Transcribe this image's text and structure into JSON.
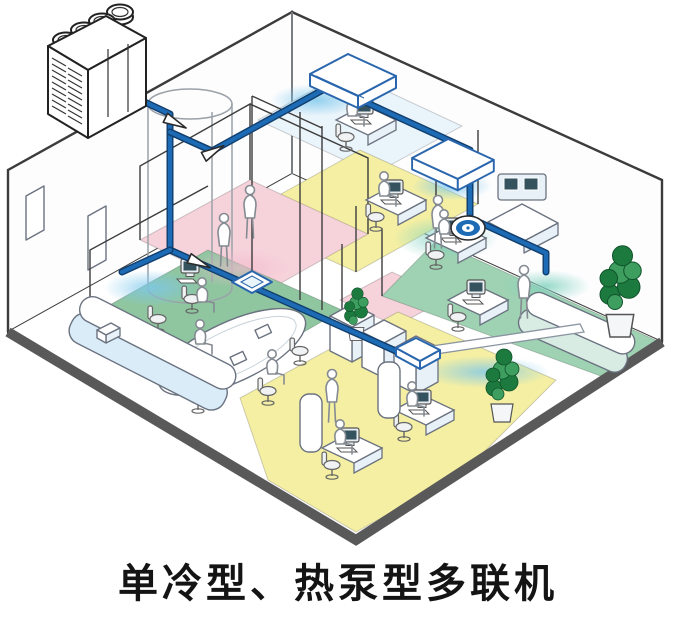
{
  "caption": {
    "text": "单冷型、热泵型多联机"
  },
  "colors": {
    "background": "#ffffff",
    "caption_color": "#141414",
    "pipe": "#1c6bb4",
    "pipe_dark": "#123e6d",
    "slab": "#595959",
    "wall": "#3c3c3c",
    "wall_light": "#9aa1a8",
    "floor_pink": "#f6d3db",
    "floor_yellow": "#f4efa3",
    "floor_green": "#8fc6a0",
    "floor_green_right": "#9ed2b2",
    "floor_pale": "#eaf4fb",
    "counter_blue": "#d9ecf8",
    "counter_teal": "#d9ece3",
    "unit_outline": "#2a66ad",
    "furniture": "#6b7280",
    "furniture_fill": "#ffffff",
    "furniture_shade": "#e8f1f7",
    "plant_dark": "#1d7a3f",
    "plant_light": "#3d9e5f",
    "people": "#858b92",
    "screen": "#35525f",
    "air_glow": "#7cc7ec",
    "pink_glow": "#f2b9cd",
    "teal_glow": "#7fd1bd"
  },
  "components": [
    "outdoor-unit",
    "refrigerant-pipe",
    "branch-joint",
    "pipe-shaft",
    "ceiling-suspended-unit",
    "round-cassette-unit",
    "four-way-cassette-unit",
    "slim-duct-unit",
    "conference-table",
    "reception-counter",
    "workstation",
    "console-desk",
    "cabinet",
    "potted-plant",
    "person",
    "wall-frame"
  ]
}
